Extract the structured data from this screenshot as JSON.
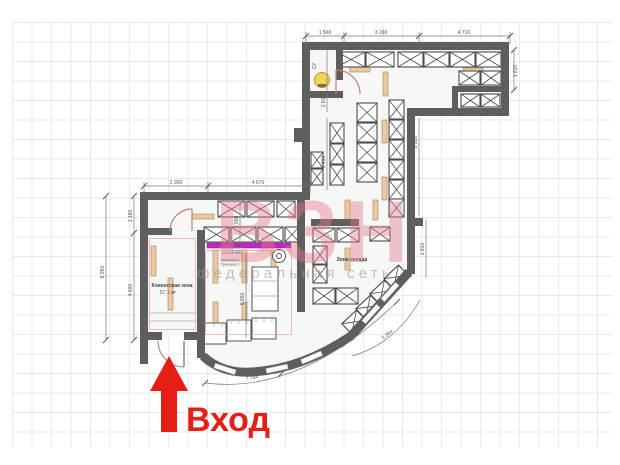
{
  "entrance": {
    "label": "Вход",
    "arrow_color": "#e51f16"
  },
  "watermark": {
    "main": "ВЗН",
    "subtitle": "федеральная сеть",
    "color": "#e4788a"
  },
  "rooms": {
    "client_zone": {
      "name": "Клиентская зона",
      "area": "57,1 м²"
    },
    "storage": {
      "name": "Зона склада"
    },
    "wc": {
      "name": "СУ"
    }
  },
  "counter": {
    "dim1": "3 100",
    "dim2": "2 800",
    "line1": "Прилавок 1",
    "line2": "Прилавок 2",
    "color": "#c428c0"
  },
  "dimensions": {
    "top": [
      "1 560",
      "3 160",
      "4 710"
    ],
    "top_left": [
      "2 300",
      "4 670"
    ],
    "left_outer": "8 950",
    "left_inner": [
      "1 180",
      "4 600"
    ],
    "right": "1 610",
    "wc_height": "2 810",
    "mid_height": "5 410",
    "storage_right": "8 920",
    "storage_lower": "2 810",
    "client_width": "2 000",
    "client_height": "5 950",
    "arc_long": "7 794",
    "arc_diag": "3 394"
  },
  "colors": {
    "wall": "#5e5e5e",
    "rack_stroke": "#4b4b4b",
    "strip": "#ecc9a2",
    "lamp": "#f2d35c"
  }
}
